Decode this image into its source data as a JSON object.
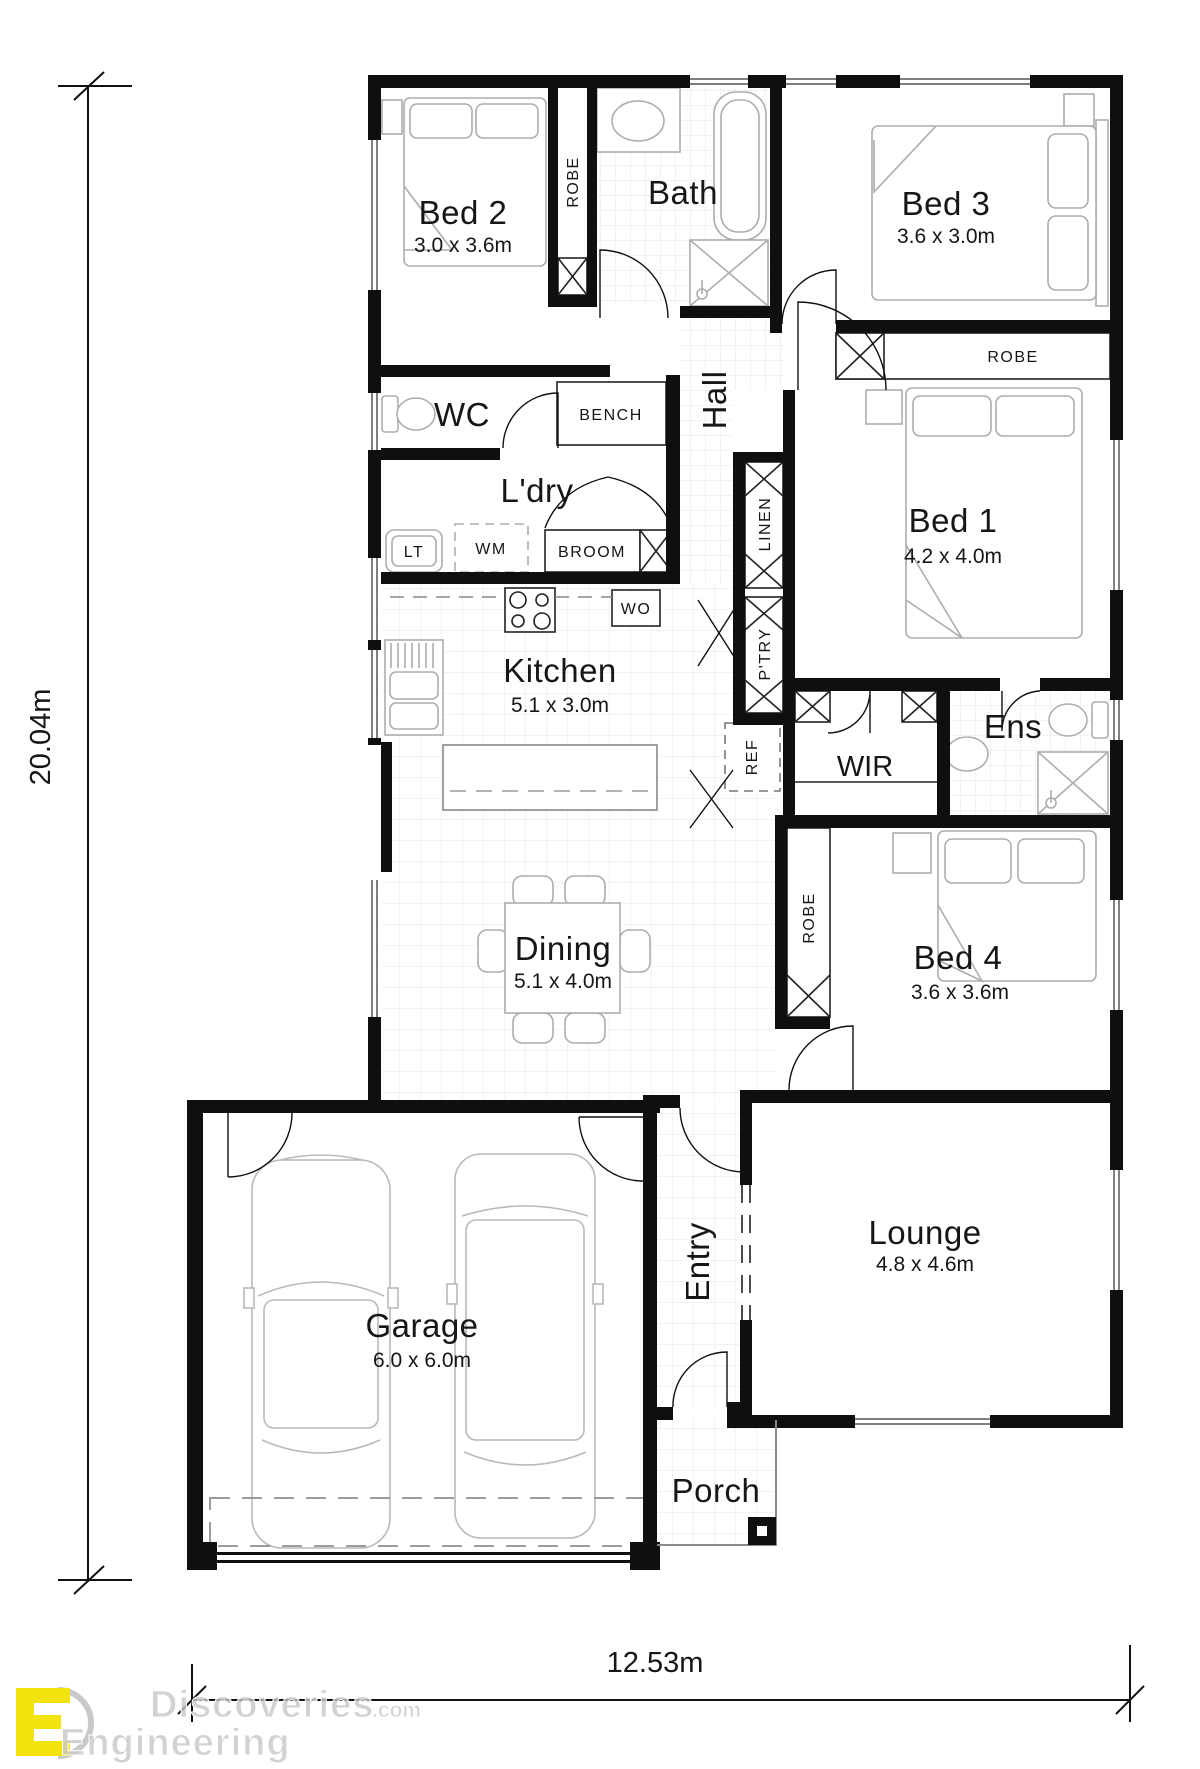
{
  "dimensions": {
    "left": "20.04m",
    "bottom": "12.53m"
  },
  "rooms": {
    "bed2": {
      "name": "Bed 2",
      "size": "3.0 x 3.6m"
    },
    "bath": {
      "name": "Bath"
    },
    "bed3": {
      "name": "Bed 3",
      "size": "3.6 x 3.0m"
    },
    "wc": {
      "name": "WC"
    },
    "hall": {
      "name": "Hall"
    },
    "bed1": {
      "name": "Bed 1",
      "size": "4.2 x 4.0m"
    },
    "ldry": {
      "name": "L'dry"
    },
    "kitchen": {
      "name": "Kitchen",
      "size": "5.1 x 3.0m"
    },
    "wir": {
      "name": "WIR"
    },
    "ens": {
      "name": "Ens"
    },
    "dining": {
      "name": "Dining",
      "size": "5.1 x 4.0m"
    },
    "bed4": {
      "name": "Bed 4",
      "size": "3.6 x 3.6m"
    },
    "garage": {
      "name": "Garage",
      "size": "6.0 x 6.0m"
    },
    "entry": {
      "name": "Entry"
    },
    "lounge": {
      "name": "Lounge",
      "size": "4.8 x 4.6m"
    },
    "porch": {
      "name": "Porch"
    }
  },
  "fixtures": {
    "robe_bed2": "ROBE",
    "robe_bed3": "ROBE",
    "robe_bed4": "ROBE",
    "bench": "BENCH",
    "lt": "LT",
    "wm": "WM",
    "broom": "BROOM",
    "wo": "WO",
    "linen": "LINEN",
    "pantry": "P'TRY",
    "ref": "REF"
  },
  "watermark": {
    "brand": "Discoveries",
    "suffix": ".com",
    "line2": "Engineering"
  },
  "colors": {
    "wall": "#0f0f0f",
    "logo_yellow": "#f2e30e",
    "grid": "#e3e3e3"
  }
}
